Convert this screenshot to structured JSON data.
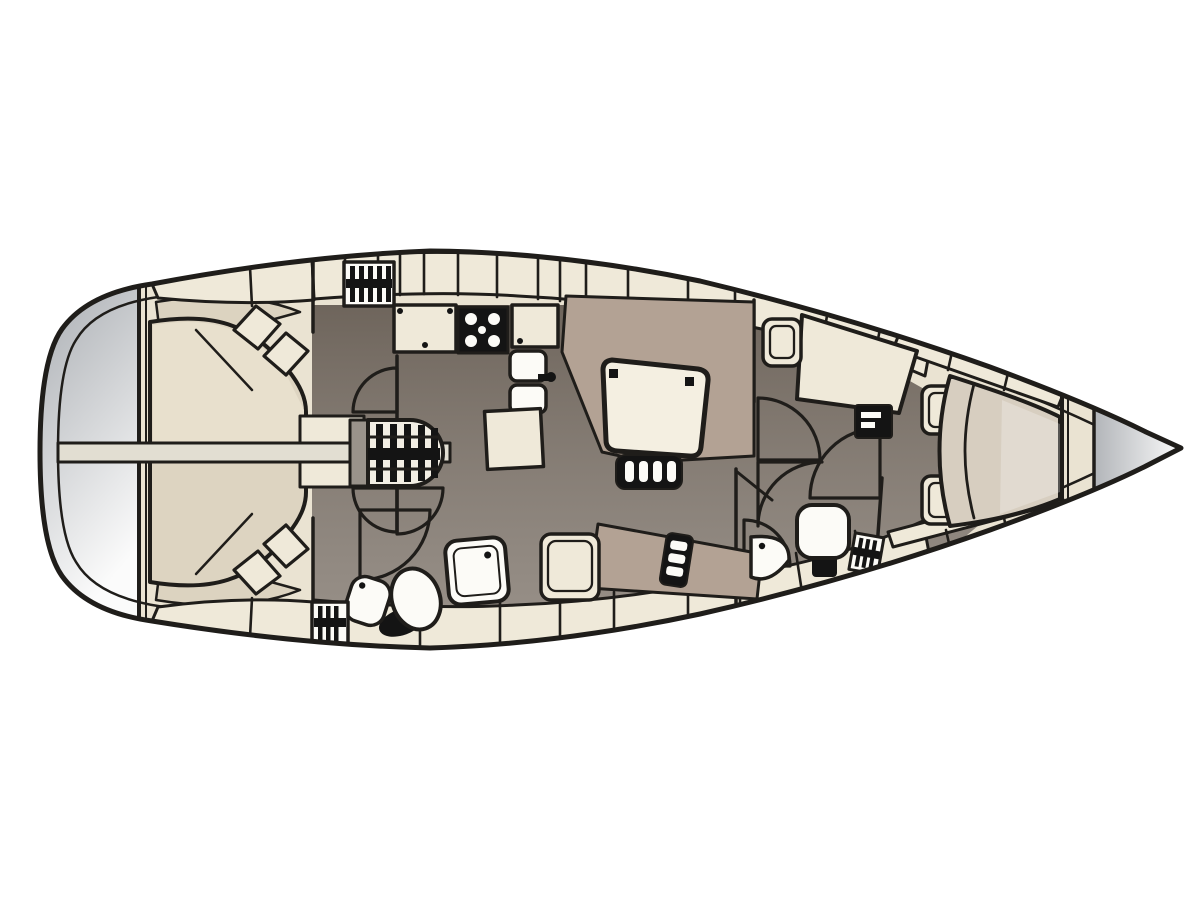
{
  "diagram": {
    "kind": "sailing-yacht-interior-floor-plan",
    "orientation": {
      "bow": "right",
      "stern": "left"
    },
    "areas": [
      {
        "id": "stern-platform",
        "label": "stern swim platform"
      },
      {
        "id": "aft-cabin",
        "label": "aft double cabin"
      },
      {
        "id": "aft-berth",
        "label": "aft island berth"
      },
      {
        "id": "keel-beam",
        "label": "centreline beam"
      },
      {
        "id": "companionway",
        "label": "companionway steps"
      },
      {
        "id": "aft-head",
        "label": "aft head with shower"
      },
      {
        "id": "galley",
        "label": "galley"
      },
      {
        "id": "salon",
        "label": "salon with dining table"
      },
      {
        "id": "nav-station",
        "label": "navigation station"
      },
      {
        "id": "forward-head",
        "label": "forward head"
      },
      {
        "id": "forward-cabin",
        "label": "forward v-berth cabin"
      },
      {
        "id": "anchor-locker",
        "label": "anchor locker"
      },
      {
        "id": "side-decks",
        "label": "side deck lockers and windows"
      }
    ]
  },
  "colors": {
    "outline": "#1f1d1a",
    "background": "#ffffff",
    "hull_deck": "#eae3d2",
    "deck_panel": "#efe9d9",
    "cabin_wall": "#dcd3c0",
    "floor_dark": "#7c7268",
    "berth": "#ddd4c1",
    "berth_highlight": "#e8e0cd",
    "upholstery": "#b3a294",
    "vberth": "#d7cec0",
    "table_top": "#f4efe1",
    "fixture_white": "#fcfbf7",
    "appliance_black": "#141414",
    "beam_band": "#e2ded2",
    "connector_gray": "#9a938b",
    "steps_fill": "#f2eee4",
    "stern_grad_start": "#a8acb1",
    "stern_grad_end": "#fbfbfb",
    "bow_grad_start": "#b2b5b9",
    "bow_grad_end": "#fafafa"
  }
}
